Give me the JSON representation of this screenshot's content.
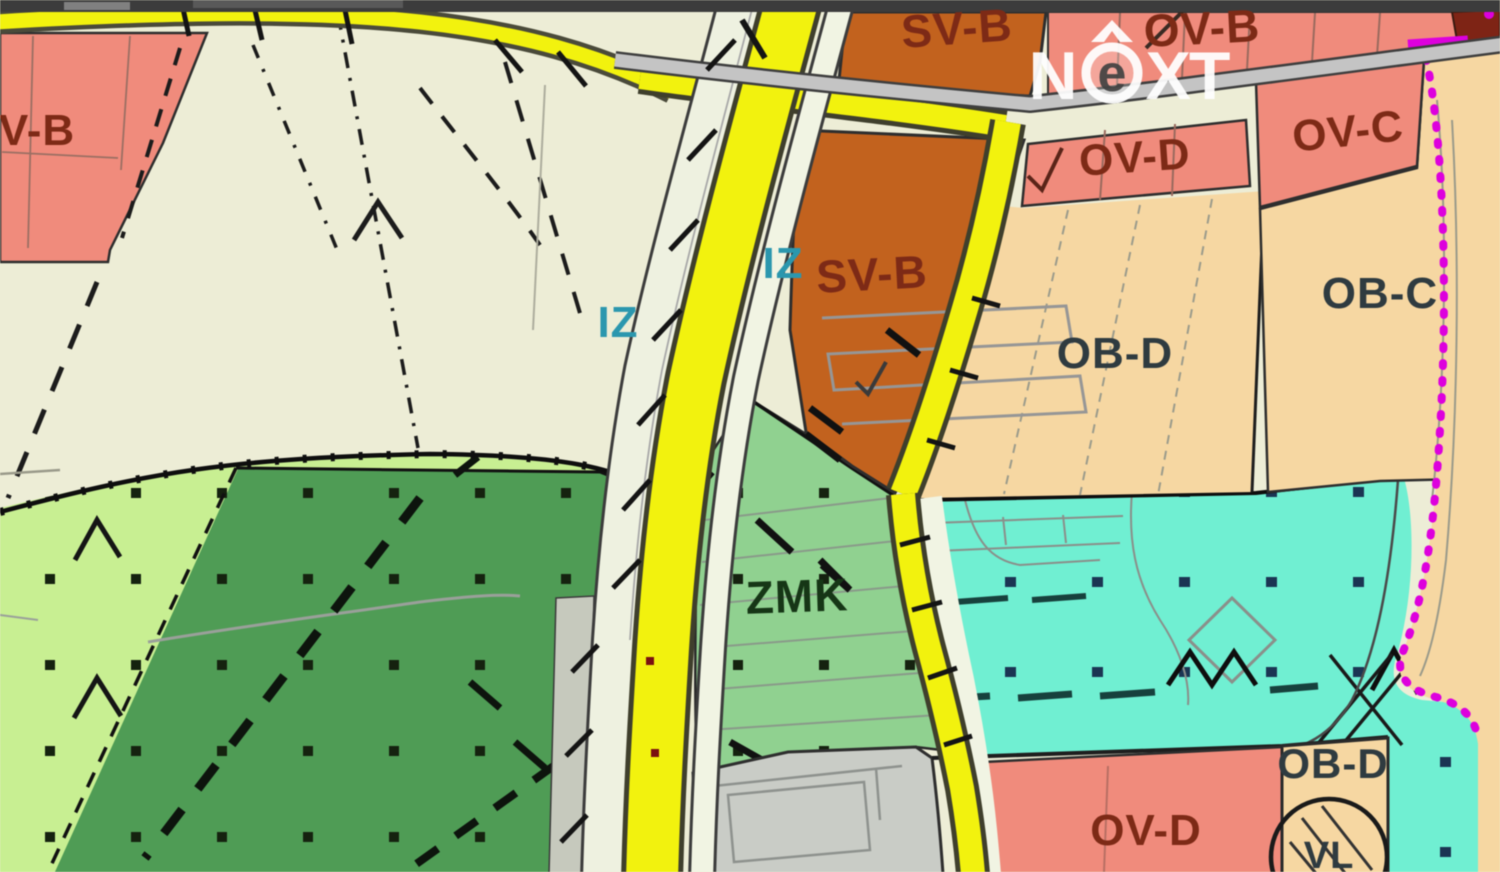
{
  "map": {
    "type": "zoning-plan-map",
    "watermark": {
      "full": "NEXT",
      "n": "N",
      "e": "e",
      "xt": "XT"
    },
    "labels": [
      {
        "id": "ov-b-left",
        "text": "V-B"
      },
      {
        "id": "sv-b-top",
        "text": "SV-B"
      },
      {
        "id": "ov-b-topright",
        "text": "OV-B"
      },
      {
        "id": "ov-d-top",
        "text": "OV-D"
      },
      {
        "id": "ov-c",
        "text": "OV-C"
      },
      {
        "id": "ob-d-main",
        "text": "OB-D"
      },
      {
        "id": "ob-c",
        "text": "OB-C"
      },
      {
        "id": "iz-left",
        "text": "IZ"
      },
      {
        "id": "iz-right",
        "text": "IZ"
      },
      {
        "id": "sv-b-mid",
        "text": "SV-B"
      },
      {
        "id": "zmk",
        "text": "ZMK"
      },
      {
        "id": "ob-d-bottom",
        "text": "OB-D"
      },
      {
        "id": "ov-d-bottom",
        "text": "OV-D"
      },
      {
        "id": "vl",
        "text": "VL"
      }
    ],
    "colors": {
      "bar": "#3C3C3C",
      "beige": "#EDEDD6",
      "salmon": "#F08B7C",
      "orange": "#C2621E",
      "peach": "#F6D7A2",
      "yellow": "#F2F20E",
      "casing": "#3F3F2C",
      "strip": "#F1F4E3",
      "rail": "#EEF1E0",
      "silver": "#C4C4C4",
      "greenmid": "#90D190",
      "greendark": "#4F9C55",
      "greenlight": "#C8EF92",
      "teal": "#70EFD2",
      "gray": "#C9CCC6",
      "magenta": "#DD00DD",
      "darkred": "#7E2415",
      "labelmaroon": "#7D2A16",
      "labeldark": "#2F3B40",
      "labelteal": "#2B97AE",
      "labelgreen": "#163616",
      "watermark": "#FFFFFF"
    }
  }
}
